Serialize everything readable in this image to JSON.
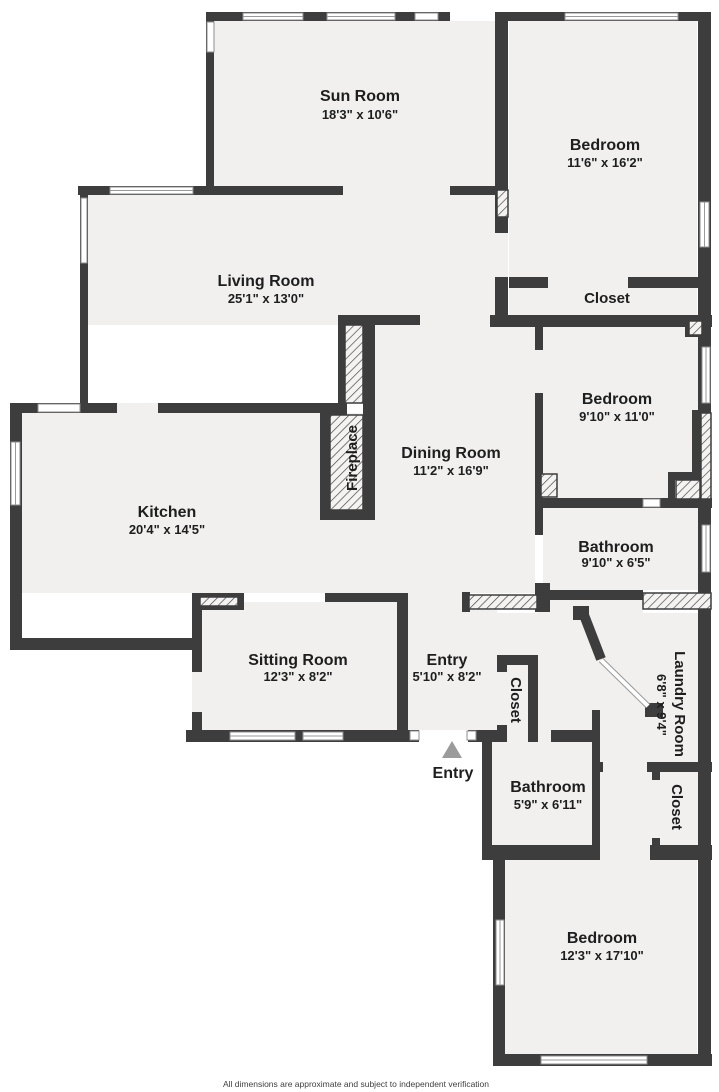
{
  "title": "Floor plan",
  "colors": {
    "wall": "#3d3d3d",
    "floor": "#f1f0ee",
    "background": "#ffffff",
    "entry_marker": "#9b9b9b",
    "label_text": "#1e1e1e"
  },
  "rooms": [
    {
      "name": "Sun Room",
      "dims": "18'3\" x 10'6\""
    },
    {
      "name": "Bedroom",
      "dims": "11'6\" x 16'2\""
    },
    {
      "name": "Living Room",
      "dims": "25'1\" x 13'0\""
    },
    {
      "name": "Closet",
      "dims": ""
    },
    {
      "name": "Bedroom",
      "dims": "9'10\" x 11'0\""
    },
    {
      "name": "Dining Room",
      "dims": "11'2\" x 16'9\""
    },
    {
      "name": "Kitchen",
      "dims": "20'4\" x 14'5\""
    },
    {
      "name": "Fireplace",
      "dims": ""
    },
    {
      "name": "Bathroom",
      "dims": "9'10\" x 6'5\""
    },
    {
      "name": "Sitting Room",
      "dims": "12'3\" x 8'2\""
    },
    {
      "name": "Entry",
      "dims": "5'10\" x 8'2\""
    },
    {
      "name": "Closet",
      "dims": ""
    },
    {
      "name": "Laundry Room",
      "dims": "6'8\" x 9'4\""
    },
    {
      "name": "Bathroom",
      "dims": "5'9\" x 6'11\""
    },
    {
      "name": "Closet",
      "dims": ""
    },
    {
      "name": "Bedroom",
      "dims": "12'3\" x 17'10\""
    }
  ],
  "entry_marker_label": "Entry",
  "footer": "All dimensions are approximate and subject to independent verification"
}
